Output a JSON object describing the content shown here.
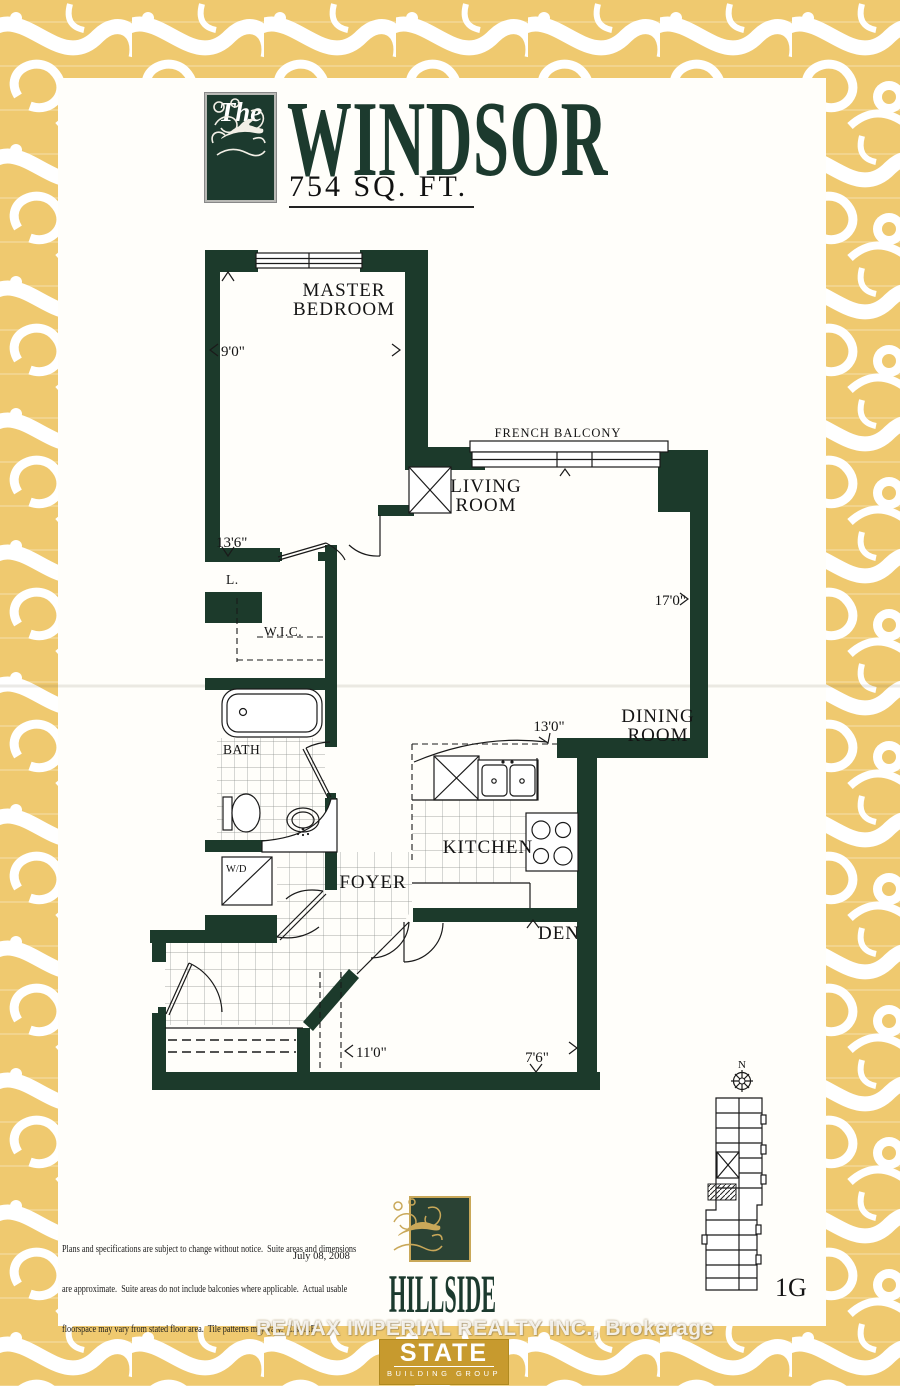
{
  "title_block": {
    "brand_word": "The",
    "name": "WINDSOR",
    "area": "754 SQ. FT."
  },
  "plan": {
    "rooms": {
      "master_bedroom": [
        "MASTER",
        "BEDROOM"
      ],
      "living_room": [
        "LIVING",
        "ROOM"
      ],
      "dining_room": [
        "DINING",
        "ROOM"
      ],
      "kitchen": "KITCHEN",
      "foyer": "FOYER",
      "den": "DEN",
      "bath": "BATH",
      "wic": "W.I.C.",
      "linen": "L.",
      "washer_dryer": "W/D",
      "french_balcony": "FRENCH BALCONY"
    },
    "dimensions": {
      "master_width": "9'0\"",
      "master_depth": "13'6\"",
      "living_depth": "17'0\"",
      "kitchen_width": "13'0\"",
      "hall_width": "11'0\"",
      "den_width": "7'6\""
    },
    "keyplan": {
      "north": "N",
      "unit": "1G"
    }
  },
  "footer": {
    "disclaimer": [
      "Plans and specifications are subject to change without notice.  Suite areas and dimensions",
      "are approximate.  Suite areas do not include balconies where applicable.  Actual usable",
      "floorspace may vary from stated floor area.  Tile patterns may vary.  E.& O.E."
    ],
    "date": "July 08, 2008",
    "hillside": {
      "name": "HILLSIDE",
      "sub": "RAVINES"
    },
    "state": {
      "name": "STATE",
      "sub": "BUILDING GROUP"
    },
    "watermark": "RE/MAX IMPERIAL REALTY INC.,  Brokerage"
  },
  "colors": {
    "wall": "#1c3a2b",
    "gold": "#efc96f",
    "gold_dark": "#c79a2e",
    "title_green": "#1c3a2e"
  }
}
